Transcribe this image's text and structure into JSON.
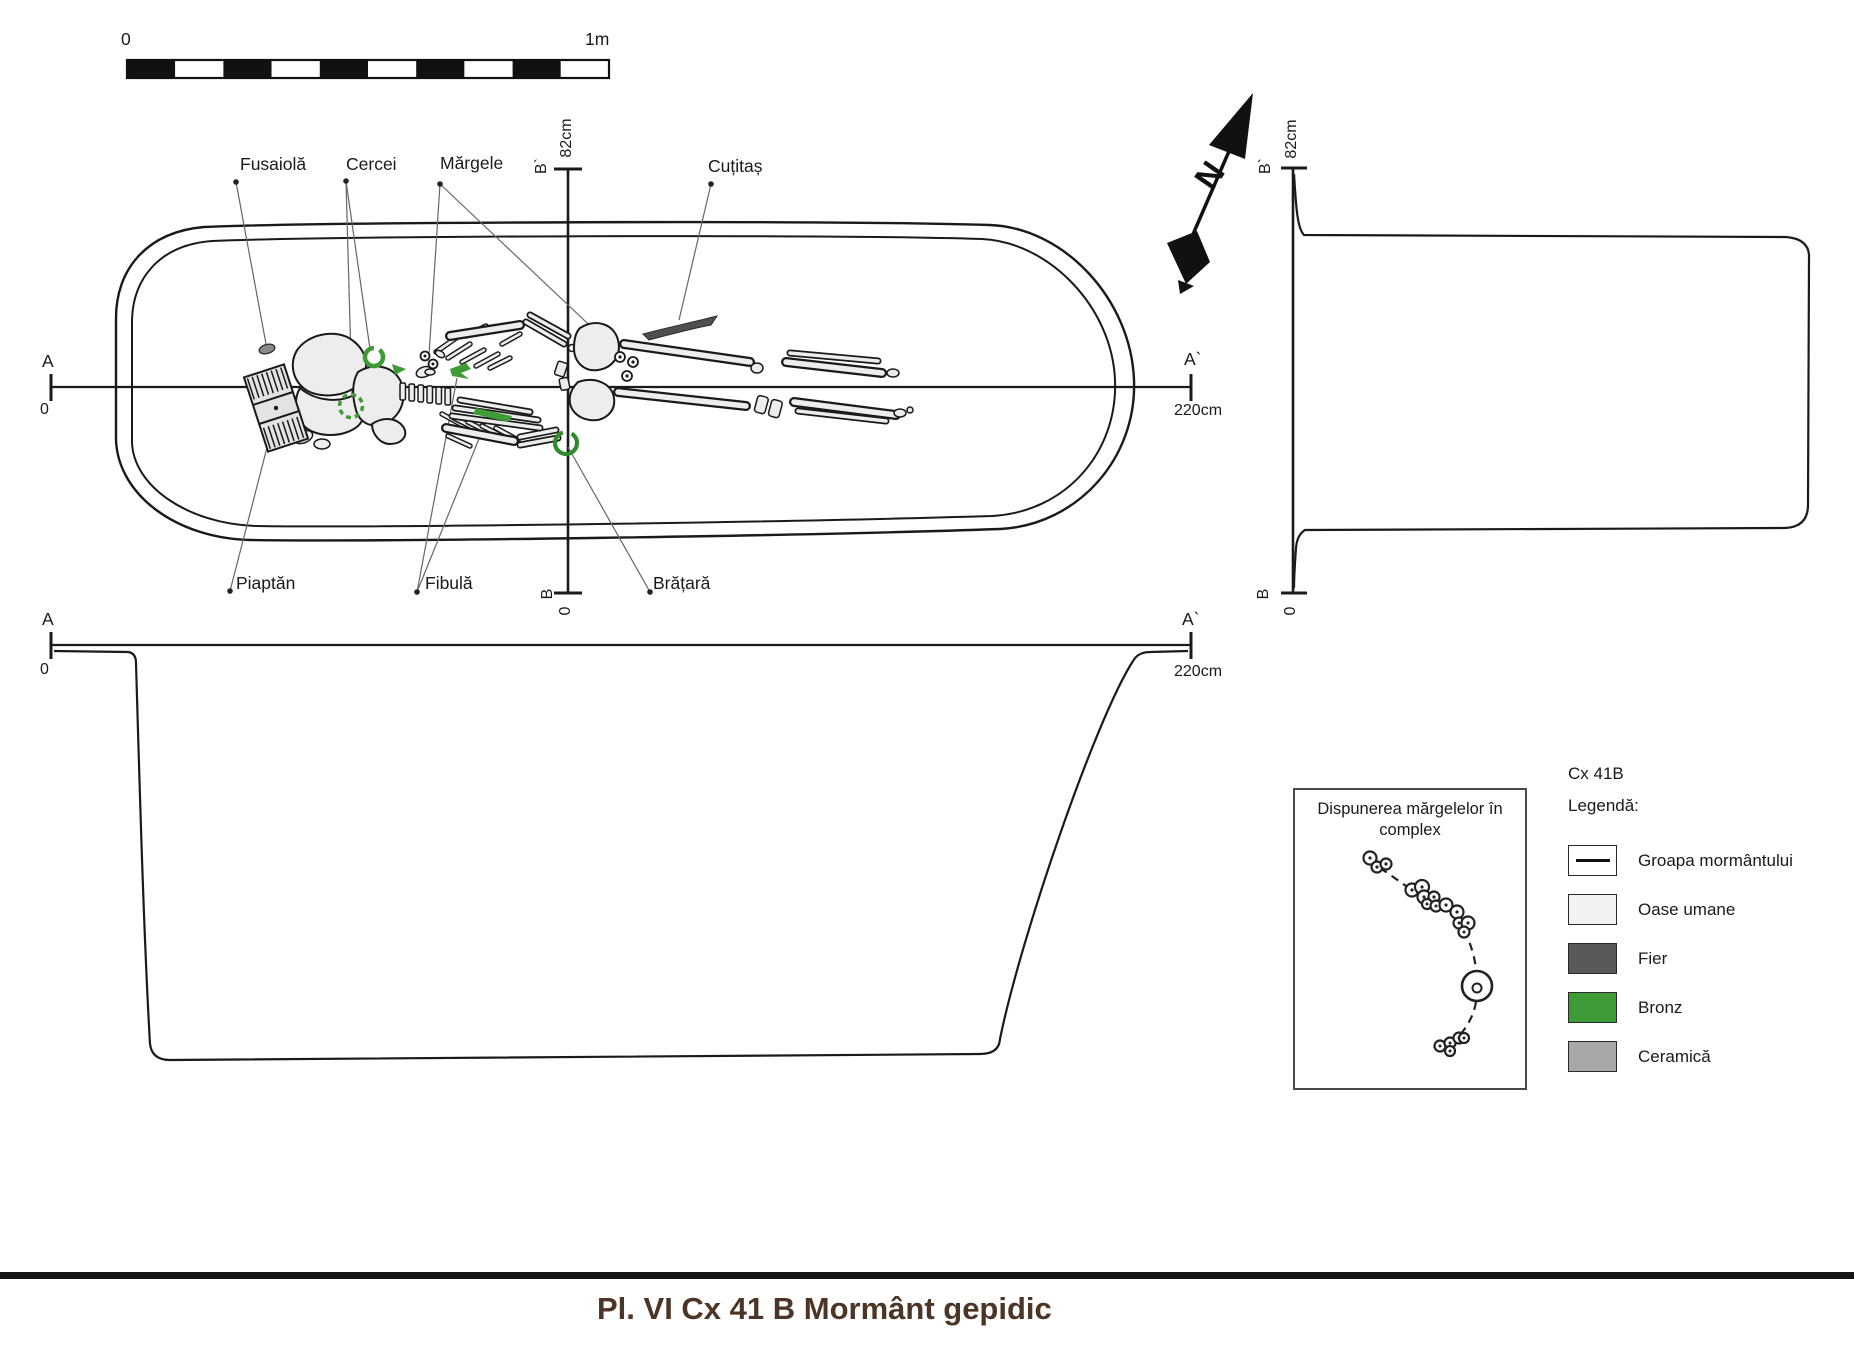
{
  "colors": {
    "bronze": "#3f9b35",
    "iron": "#595959",
    "ceramic": "#a8a8a8",
    "human_bone_swatch": "#f2f2f2",
    "caption_brown": "#4d3526"
  },
  "scale_bar": {
    "start": "0",
    "end": "1m"
  },
  "plan": {
    "artifact_labels": {
      "fusaiola": "Fusaiolă",
      "cercei": "Cercei",
      "margele": "Mărgele",
      "cutitas": "Cuțitaș",
      "piaptan": "Piaptăn",
      "fibula": "Fibulă",
      "bratara": "Brățară"
    }
  },
  "axes": {
    "a": "A",
    "a_prime": "A`",
    "zero": "0",
    "length": "220cm",
    "b": "B",
    "b_prime": "B`",
    "depth": "82cm"
  },
  "north": {
    "n": "N"
  },
  "inset": {
    "title_line1": "Dispunerea mărgelelor în",
    "title_line2": "complex"
  },
  "legend": {
    "context": "Cx 41B",
    "heading": "Legendă:",
    "items": [
      {
        "label": "Groapa mormântului",
        "swatch": "outline-line"
      },
      {
        "label": "Oase umane",
        "color": "#f2f2f2"
      },
      {
        "label": "Fier",
        "color": "#595959"
      },
      {
        "label": "Bronz",
        "color": "#3f9b35"
      },
      {
        "label": "Ceramică",
        "color": "#a8a8a8"
      }
    ]
  },
  "caption": "Pl. VI  Cx 41 B Mormânt gepidic"
}
